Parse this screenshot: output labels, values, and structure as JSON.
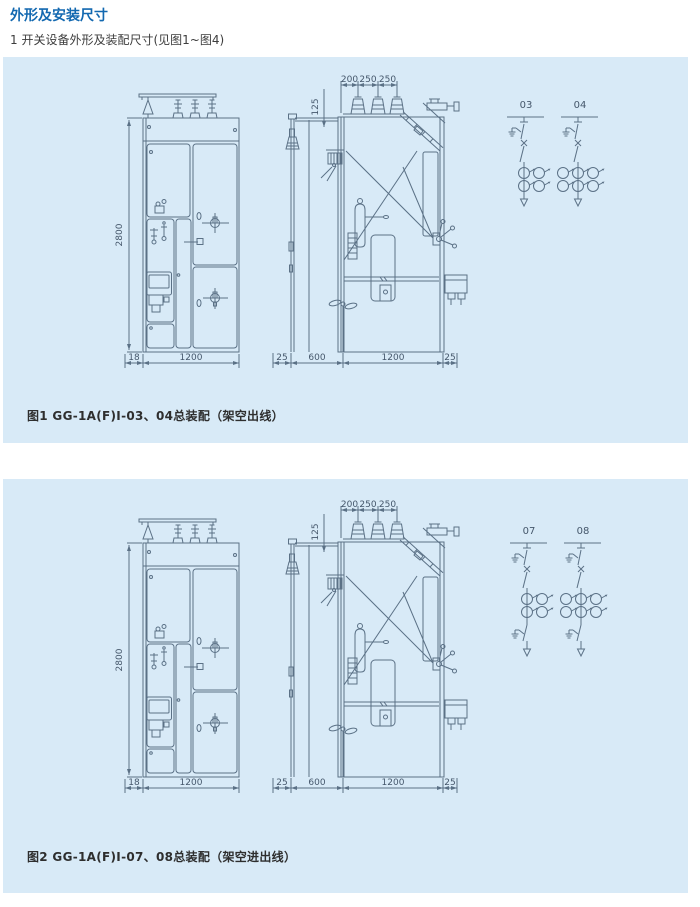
{
  "page": {
    "title": "外形及安装尺寸",
    "subtitle": "1 开关设备外形及装配尺寸(见图1~图4)"
  },
  "colors": {
    "accent_blue": "#1268b0",
    "panel_background": "#d8eaf7",
    "drawing_line": "#5b7186"
  },
  "dimensions": {
    "front": {
      "height": "2800",
      "left_offset": "18",
      "width": "1200"
    },
    "side": {
      "top_spacings": [
        "200",
        "250",
        "250"
      ],
      "bushing_offset": "125",
      "bottom": [
        "25",
        "600",
        "1200",
        "25"
      ]
    }
  },
  "figure1": {
    "caption": "图1 GG-1A(F)I-03、04总装配（架空出线）",
    "schemes": [
      {
        "label": "03",
        "ct_columns": 2,
        "lower_disconnector": false
      },
      {
        "label": "04",
        "ct_columns": 3,
        "lower_disconnector": false
      }
    ]
  },
  "figure2": {
    "caption": "图2 GG-1A(F)I-07、08总装配（架空进出线）",
    "schemes": [
      {
        "label": "07",
        "ct_columns": 2,
        "lower_disconnector": true
      },
      {
        "label": "08",
        "ct_columns": 3,
        "lower_disconnector": true
      }
    ]
  }
}
